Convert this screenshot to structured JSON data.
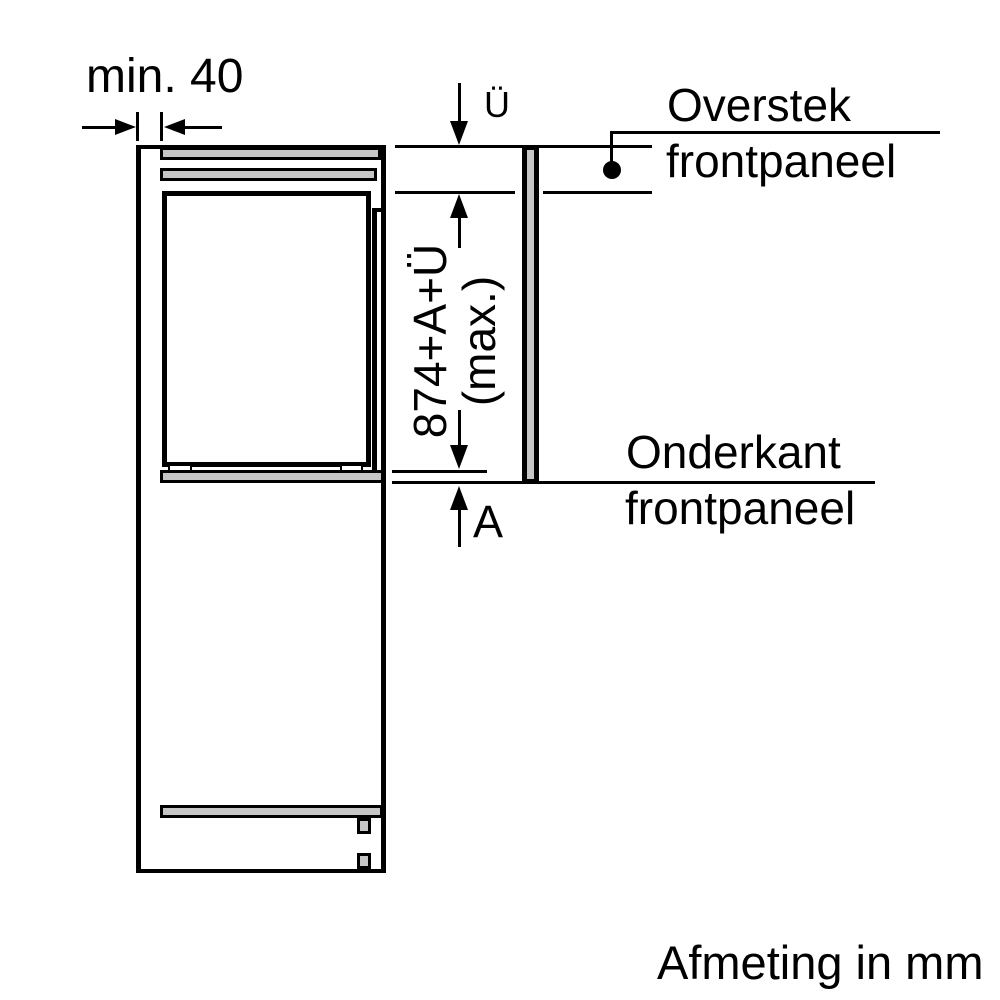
{
  "diagram": {
    "top_dimension_label": "min. 40",
    "overhang_dimension_label": "Ü",
    "panel_height_label_line1": "874+A+Ü",
    "panel_height_label_line2": "(max.)",
    "bottom_dimension_label": "A",
    "callout_overstek_line1": "Overstek",
    "callout_overstek_line2": "frontpaneel",
    "callout_onderkant_line1": "Onderkant",
    "callout_onderkant_line2": "frontpaneel",
    "units_note": "Afmeting in mm"
  },
  "colors": {
    "line": "#000000",
    "panel_fill": "#c6c6c6",
    "background": "#ffffff"
  }
}
